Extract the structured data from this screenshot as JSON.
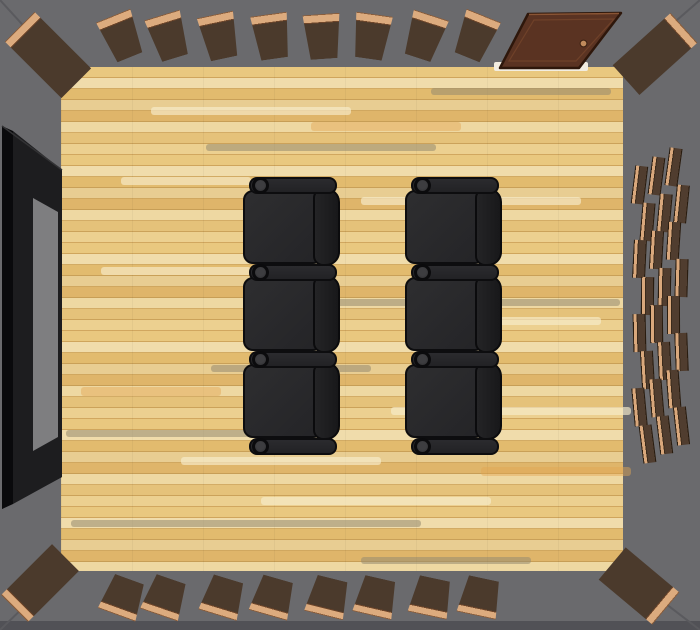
{
  "scene": {
    "kind": "3d-floor-plan-top-down-view",
    "room": "home theater room",
    "colors": {
      "wall": "#6a6a6d",
      "wall_bottom_edge": "#515156",
      "miter_line": "#5a5a5e",
      "floor_base": "#e6c57e",
      "floor_streak_gray": "#968b70",
      "floor_streak_light": "#f8ecd0",
      "plank_body": "#4b3a2c",
      "plank_cap": "#dcab7e",
      "plank_edge": "#2a1d10",
      "door_body": "#5a3322",
      "door_trim": "#2e170b",
      "door_inner_line": "#6f4129",
      "door_knob": "#c08b5c",
      "threshold": "#f2ede1",
      "seat_body": "#2a2a2c",
      "seat_back": "#1e1e20",
      "seat_outline": "#0d0d0f",
      "screen_frame": "#0f0f11",
      "screen_frame_inner": "#1d1d1f",
      "screen_surface": "#7e7e80"
    },
    "layout": {
      "canvas": {
        "w": 700,
        "h": 630
      },
      "floor": {
        "x": 61,
        "y": 67,
        "w": 562,
        "h": 504
      }
    },
    "miters": {
      "top_left": "0,0 61,67",
      "top_right": "700,0 623,67",
      "bottom_left": "0,630 61,571",
      "bottom_right": "700,630 623,571"
    },
    "screen": {
      "label": "wall-mounted screen",
      "outer": "2,126 62,170 62,477 2,509",
      "inner_frame": "13,131 62,170 62,477 13,504",
      "ridge": "2,126 13,131 13,504 2,509",
      "surface": "33,198 58,212 58,437 33,451",
      "top_highlight": "2,126 62,170"
    },
    "door": {
      "label": "open door at top right",
      "panel": "528,14 621,13 579,68 500,68",
      "inner": "534,20 614,19 576,61 509,61",
      "knob": {
        "cx": 583.5,
        "cy": 43.5,
        "r": 3.4
      },
      "threshold": {
        "x": 494,
        "y": 62,
        "w": 94,
        "h": 9
      }
    },
    "top_planks": {
      "y": 14,
      "w": 37,
      "cap_h": 9,
      "body_h": 36,
      "cap": "top",
      "taper": "down",
      "items": [
        {
          "cx": 121,
          "rot": -22
        },
        {
          "cx": 168,
          "rot": -17
        },
        {
          "cx": 219,
          "rot": -12
        },
        {
          "cx": 271,
          "rot": -8
        },
        {
          "cx": 322,
          "rot": -4
        },
        {
          "cx": 371,
          "rot": 8
        },
        {
          "cx": 424,
          "rot": 18
        },
        {
          "cx": 475,
          "rot": 22
        }
      ]
    },
    "bottom_planks": {
      "y": 578,
      "w": 40,
      "cap_h": 8,
      "body_h": 30,
      "cap": "bottom",
      "taper": "up",
      "items": [
        {
          "cx": 123,
          "rot": 20
        },
        {
          "cx": 165,
          "rot": 19
        },
        {
          "cx": 223,
          "rot": 17
        },
        {
          "cx": 273,
          "rot": 16
        },
        {
          "cx": 328,
          "rot": 14
        },
        {
          "cx": 376,
          "rot": 13
        },
        {
          "cx": 431,
          "rot": 12
        },
        {
          "cx": 480,
          "rot": 12
        }
      ]
    },
    "corner_planks": [
      {
        "cx": 48,
        "cy": 55,
        "w": 42,
        "h": 80,
        "rot": -45,
        "cap": "top"
      },
      {
        "cx": 655,
        "cy": 54,
        "w": 40,
        "h": 78,
        "rot": 48,
        "cap": "top"
      },
      {
        "cx": 40,
        "cy": 583,
        "w": 38,
        "h": 72,
        "rot": 45,
        "cap": "bottom"
      },
      {
        "cx": 639,
        "cy": 586,
        "w": 42,
        "h": 70,
        "rot": -50,
        "cap": "bottom"
      }
    ],
    "wall_grid": {
      "label": "right wall slat grid",
      "cols": [
        {
          "x": 633,
          "y0": 166
        },
        {
          "x": 650,
          "y0": 157
        },
        {
          "x": 667,
          "y0": 148
        }
      ],
      "rows": 8,
      "pitch": 37,
      "stagger_x": 8,
      "w": 13,
      "h": 38,
      "pivot_y": 310,
      "rot_k": 0.055
    },
    "recliners": {
      "label": "theater recliner seats",
      "columns": [
        {
          "x": 243
        },
        {
          "x": 405
        }
      ],
      "rows": 3,
      "seat": {
        "w": 80,
        "h": 74,
        "ys": [
          190,
          277,
          364
        ]
      },
      "back": {
        "dx": 70,
        "w": 27,
        "h": 78,
        "ys": [
          188,
          275,
          362
        ]
      },
      "bar": {
        "dx": 6,
        "w": 88,
        "h": 17,
        "ys": [
          177,
          264,
          351,
          438
        ]
      },
      "cup": {
        "dx": 9,
        "size": 17
      }
    }
  }
}
